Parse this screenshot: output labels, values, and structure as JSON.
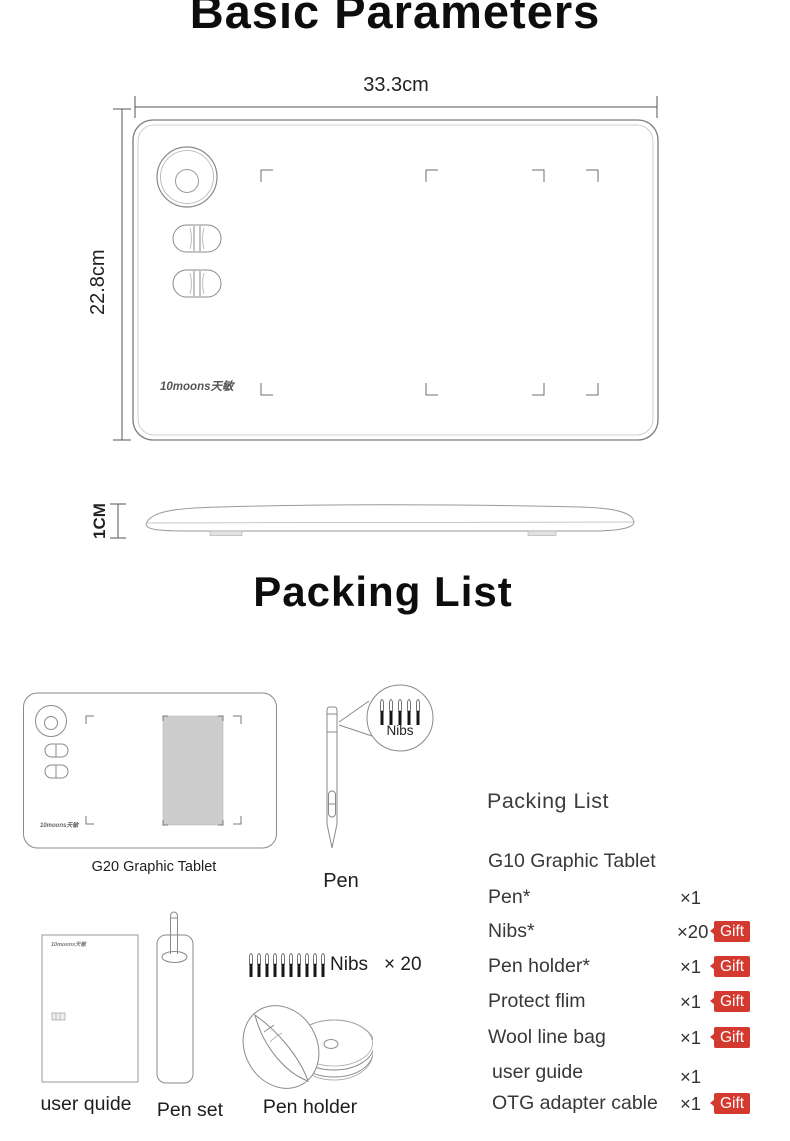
{
  "titles": {
    "basic": "Basic Parameters",
    "packing": "Packing List"
  },
  "dimensions": {
    "width": "33.3cm",
    "height": "22.8cm",
    "thickness": "1CM"
  },
  "brand": {
    "logo": "10moons天敏"
  },
  "figures": {
    "g20_caption": "G20 Graphic Tablet",
    "pen_caption": "Pen",
    "nibs_callout_label": "Nibs",
    "user_guide_caption": "user quide",
    "pen_set_caption": "Pen set",
    "nibs_row_label": "Nibs",
    "nibs_row_qty": "× 20",
    "pen_holder_caption": "Pen holder"
  },
  "packing_list": {
    "heading": "Packing List",
    "gift_label": "Gift",
    "gift_color": "#d3392f",
    "items": [
      {
        "name": "G10 Graphic Tablet",
        "qty": ""
      },
      {
        "name": "Pen*",
        "qty": "×1"
      },
      {
        "name": "Nibs*",
        "qty": "×20",
        "gift": true
      },
      {
        "name": "Pen holder*",
        "qty": "×1",
        "gift": true
      },
      {
        "name": "Protect flim",
        "qty": "×1",
        "gift": true
      },
      {
        "name": "Wool line bag",
        "qty": "×1",
        "gift": true
      },
      {
        "name": "user guide",
        "qty": "×1"
      },
      {
        "name": "OTG adapter cable",
        "qty": "×1",
        "gift": true
      }
    ]
  }
}
